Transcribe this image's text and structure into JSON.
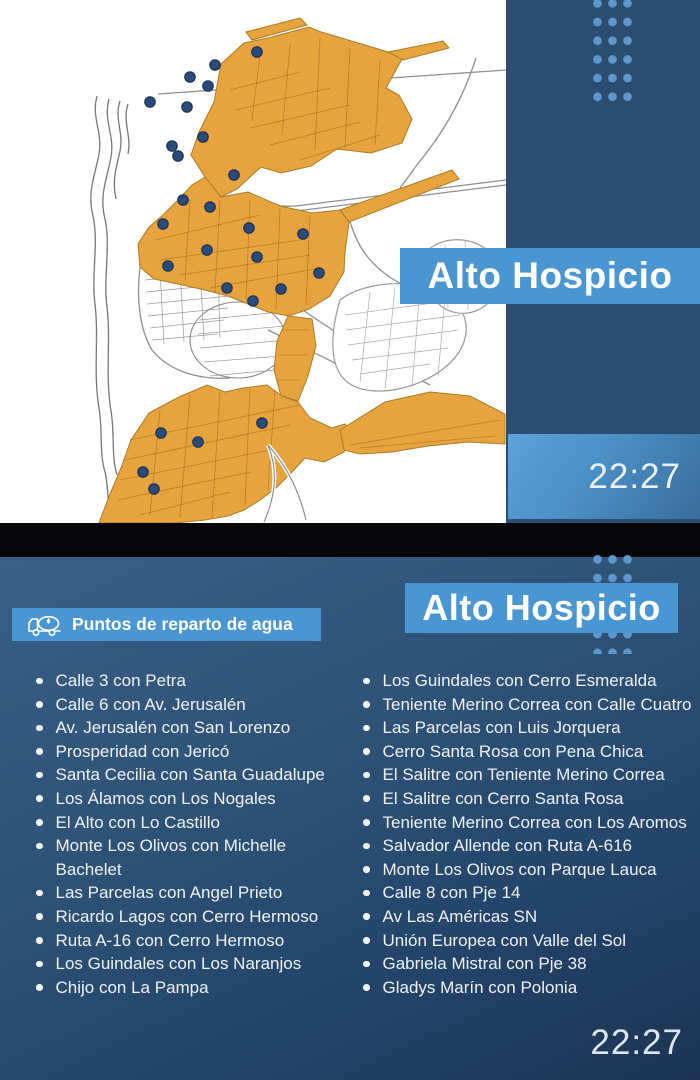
{
  "top_panel": {
    "title": "Alto Hospicio",
    "time": "22:27"
  },
  "bottom_panel": {
    "header": {
      "label": "Puntos de reparto de agua",
      "icon": "water-truck-icon"
    },
    "title": "Alto Hospicio",
    "time": "22:27",
    "left_column": [
      "Calle 3 con Petra",
      "Calle 6 con Av. Jerusalén",
      "Av. Jerusalén con San Lorenzo",
      "Prosperidad con Jericó",
      "Santa Cecilia con Santa Guadalupe",
      "Los Álamos con Los Nogales",
      "El Alto con Lo Castillo",
      "Monte Los Olivos con Michelle Bachelet",
      "Las Parcelas con Angel Prieto",
      "Ricardo Lagos con Cerro Hermoso",
      "Ruta A-16 con Cerro Hermoso",
      "Los Guindales con Los Naranjos",
      "Chijo con La Pampa"
    ],
    "right_column": [
      "Los Guindales con Cerro Esmeralda",
      "Teniente Merino Correa con Calle Cuatro",
      "Las Parcelas con Luis Jorquera",
      "Cerro Santa Rosa con Pena Chica",
      "El Salitre con Teniente Merino Correa",
      "El Salitre con Cerro Santa Rosa",
      "Teniente Merino Correa con Los Aromos",
      "Salvador Allende con Ruta A-616",
      "Monte Los Olivos con Parque Lauca",
      "Calle 8 con Pje 14",
      "Av Las Américas SN",
      "Unión Europea con Valle del Sol",
      "Gabriela Mistral con Pje 38",
      "Gladys Marín con Polonia"
    ]
  },
  "map": {
    "marker_count": 27
  },
  "colors": {
    "banner_blue": "#4a96d3",
    "sidebar_navy": "#2d4d70",
    "dot_blue": "#5d97cd",
    "map_orange": "#e7a43e",
    "marker_navy": "#2b4b79"
  }
}
